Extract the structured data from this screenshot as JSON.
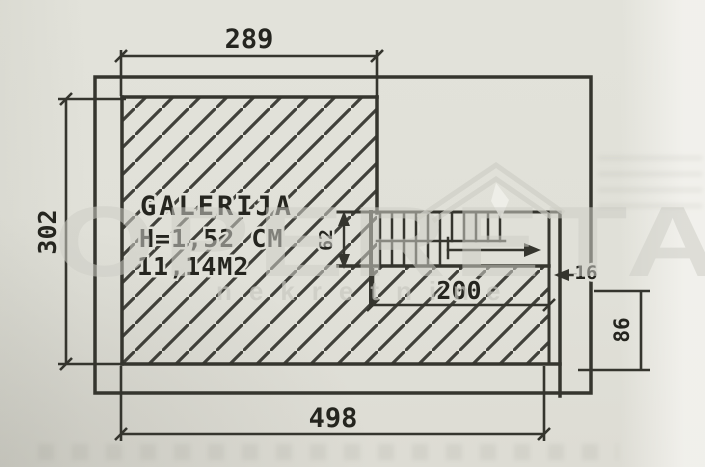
{
  "room": {
    "name": "GALERIJA",
    "height_note": "H=1,52 CM",
    "area_note": "11,14M2"
  },
  "dimensions": {
    "top_width": "289",
    "left_height": "302",
    "bottom_width": "498",
    "stair_length": "200",
    "stair_run_width": "62",
    "edge_offset": "16",
    "right_height": "86"
  },
  "watermark": {
    "brand": "OPERETA",
    "subtitle": "nekretnine"
  }
}
